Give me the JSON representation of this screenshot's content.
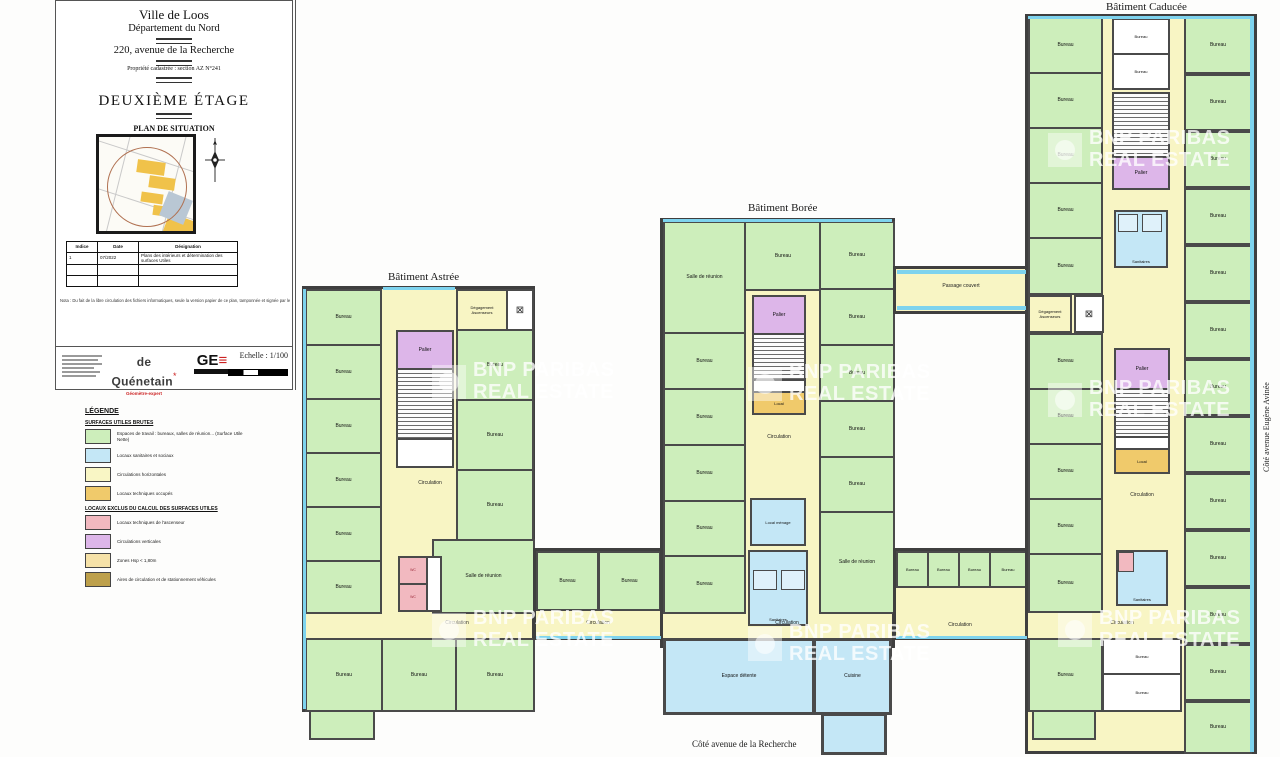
{
  "title_block": {
    "city": "Ville de Loos",
    "department": "Département du Nord",
    "address": "220, avenue de la Recherche",
    "cadastre": "Propriété cadastrée : section AZ N°241",
    "floor_title": "DEUXIÈME ÉTAGE",
    "situation_title": "PLAN DE SITUATION",
    "revision_table": {
      "headers": [
        "Indice",
        "Date",
        "Désignation"
      ],
      "rows": [
        [
          "1",
          "07/2022",
          "Plans des intérieurs et détermination des surfaces Utiles"
        ]
      ]
    },
    "note": "Nota : Du fait de la libre circulation des fichiers informatiques, seule la version papier de ce plan, tamponnée et signée par le Géomètre-Expert, engage sa responsabilité.",
    "surveyor_name": "de Quénetain",
    "surveyor_mark": "*",
    "surveyor_subtitle": "Géomètre-expert",
    "logo_ge": "GE",
    "scale_label": "Echelle : 1/100"
  },
  "legend": {
    "title": "LÉGENDE",
    "sections": [
      {
        "title": "SURFACES UTILES BRUTES",
        "items": [
          {
            "color": "#cdeebb",
            "label": "Espaces de travail : bureaux, salles de réunion... (Surface Utile Nette)"
          },
          {
            "color": "#c4e7f6",
            "label": "Locaux sanitaires et sociaux"
          },
          {
            "color": "#f9f6c5",
            "label": "Circulations horizontales"
          },
          {
            "color": "#f0ca6b",
            "label": "Locaux techniques occupés"
          }
        ]
      },
      {
        "title": "LOCAUX EXCLUS DU CALCUL DES SURFACES UTILES",
        "items": [
          {
            "color": "#f2b9c0",
            "label": "Locaux techniques de l'ascenseur"
          },
          {
            "color": "#ddb6e9",
            "label": "Circulations verticales"
          },
          {
            "color": "#f6e2a8",
            "label": "Zones Hsp < 1,80m"
          },
          {
            "color": "#bda04b",
            "label": "Aires de circulation et de stationnement véhicules"
          }
        ]
      }
    ]
  },
  "plan": {
    "buildings": {
      "astree": "Bâtiment Astrée",
      "boree": "Bâtiment Borée",
      "caducee": "Bâtiment Caducée"
    },
    "streets": {
      "bottom": "Côté avenue de la Recherche",
      "right": "Côté avenue Eugène Avinée"
    },
    "watermark": {
      "line1": "BNP PARIBAS",
      "line2": "REAL ESTATE"
    },
    "icons": {
      "elevator": "⊠"
    },
    "room_labels": {
      "bureau": "Bureau",
      "salle_reunion": "Salle de réunion",
      "circulation": "Circulation",
      "palier": "Palier",
      "sanitaires": "Sanitaires",
      "local_menage": "Local ménage",
      "local": "Local",
      "espace_detente": "Espace détente",
      "cuisine": "Cuisine",
      "passage_couvert": "Passage couvert",
      "degagement": "Dégagement Ascenseurs",
      "wc": "WC"
    }
  }
}
